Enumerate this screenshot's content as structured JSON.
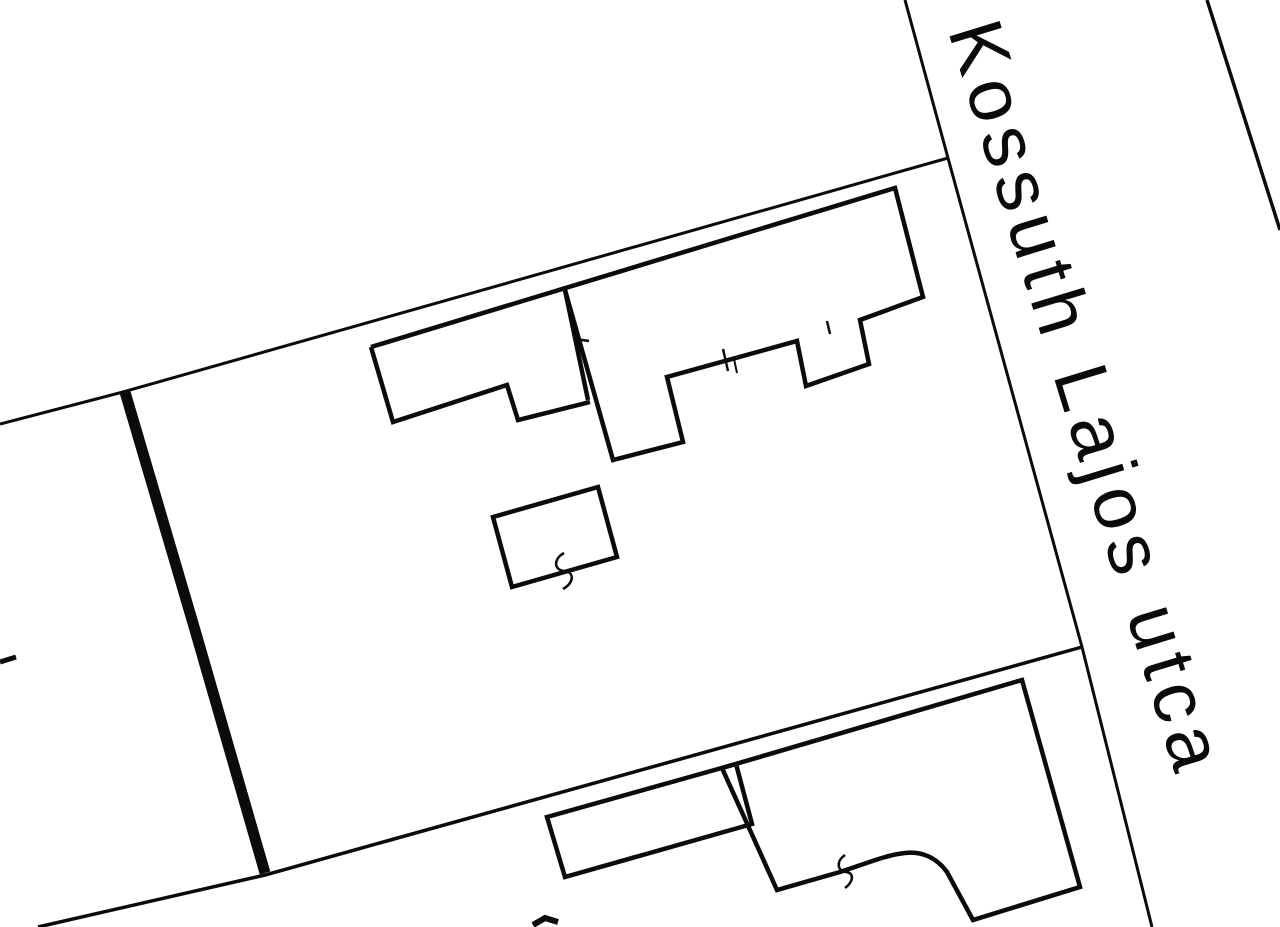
{
  "map": {
    "background": "#ffffff",
    "stroke_color": "#0b0b0b",
    "street_label": {
      "text": "Kossuth Lajos utca"
    },
    "lines": [
      {
        "name": "street-left-edge",
        "w": 3,
        "closed": false,
        "pts": [
          [
            905,
            0
          ],
          [
            948,
            158
          ],
          [
            1082,
            647
          ],
          [
            1152,
            927
          ]
        ]
      },
      {
        "name": "street-right-edge",
        "w": 3.5,
        "closed": false,
        "pts": [
          [
            1207,
            0
          ],
          [
            1280,
            230
          ]
        ]
      },
      {
        "name": "upper-parcel-boundary",
        "w": 3,
        "closed": false,
        "pts": [
          [
            0,
            424
          ],
          [
            123,
            392
          ],
          [
            948,
            158
          ]
        ]
      },
      {
        "name": "lower-parcel-boundary",
        "w": 3.5,
        "closed": false,
        "pts": [
          [
            38,
            927
          ],
          [
            265,
            875
          ],
          [
            1082,
            647
          ]
        ]
      },
      {
        "name": "selected-parcel-thick-boundary",
        "w": 11,
        "closed": false,
        "pts": [
          [
            125,
            392
          ],
          [
            195,
            630
          ],
          [
            265,
            873
          ]
        ]
      },
      {
        "name": "left-edge-tick",
        "w": 5,
        "closed": false,
        "pts": [
          [
            0,
            662
          ],
          [
            16,
            657
          ]
        ]
      },
      {
        "name": "building-upper-outline",
        "w": 4.5,
        "closed": false,
        "pts": [
          [
            371,
            347
          ],
          [
            895,
            188
          ],
          [
            923,
            297
          ],
          [
            860,
            320
          ],
          [
            869,
            364
          ],
          [
            806,
            386
          ],
          [
            797,
            341
          ],
          [
            667,
            377
          ],
          [
            683,
            442
          ],
          [
            613,
            460
          ],
          [
            565,
            290
          ]
        ]
      },
      {
        "name": "building-upper-left-wing",
        "w": 4.5,
        "closed": false,
        "pts": [
          [
            371,
            347
          ],
          [
            393,
            422
          ],
          [
            507,
            385
          ],
          [
            518,
            420
          ],
          [
            590,
            402
          ]
        ]
      },
      {
        "name": "building-upper-internal-wall",
        "w": 4.5,
        "closed": false,
        "pts": [
          [
            565,
            290
          ],
          [
            588,
            400
          ]
        ]
      },
      {
        "name": "survey-tick-1",
        "w": 2.5,
        "closed": false,
        "pts": [
          [
            575,
            339
          ],
          [
            589,
            341
          ]
        ]
      },
      {
        "name": "survey-tick-2",
        "w": 2.5,
        "closed": false,
        "pts": [
          [
            723,
            349
          ],
          [
            728,
            371
          ]
        ]
      },
      {
        "name": "survey-tick-3",
        "w": 2,
        "closed": false,
        "pts": [
          [
            734,
            359
          ],
          [
            737,
            373
          ]
        ]
      },
      {
        "name": "survey-tick-4",
        "w": 2.5,
        "closed": false,
        "pts": [
          [
            827,
            321
          ],
          [
            830,
            334
          ]
        ]
      },
      {
        "name": "building-small-outline",
        "w": 4.5,
        "closed": true,
        "pts": [
          [
            493,
            517
          ],
          [
            598,
            487
          ],
          [
            617,
            557
          ],
          [
            512,
            587
          ]
        ]
      },
      {
        "name": "building-strip-outline",
        "w": 4.5,
        "closed": true,
        "pts": [
          [
            547,
            817
          ],
          [
            736,
            764
          ],
          [
            752,
            824
          ],
          [
            565,
            877
          ]
        ]
      },
      {
        "name": "bottom-cutoff-text-mark",
        "w": 6,
        "closed": false,
        "pts": [
          [
            533,
            925
          ],
          [
            545,
            918
          ],
          [
            558,
            922
          ]
        ]
      }
    ],
    "paths": [
      {
        "name": "building-lower-outline",
        "w": 4.5,
        "d": "M 722,768 L 1022,680 L 1080,887 L 973,920 L 947,872 C 936,857 921,851 905,853 C 886,855 868,863 840,872 L 777,890 Z"
      },
      {
        "name": "squiggle-mark-1",
        "w": 2.5,
        "d": "M 564,553 C 553,559 554,570 564,571 C 575,572 574,583 563,589"
      },
      {
        "name": "squiggle-mark-2",
        "w": 2.5,
        "d": "M 845,855 C 836,861 837,871 846,872 C 855,873 853,882 845,888"
      }
    ]
  }
}
